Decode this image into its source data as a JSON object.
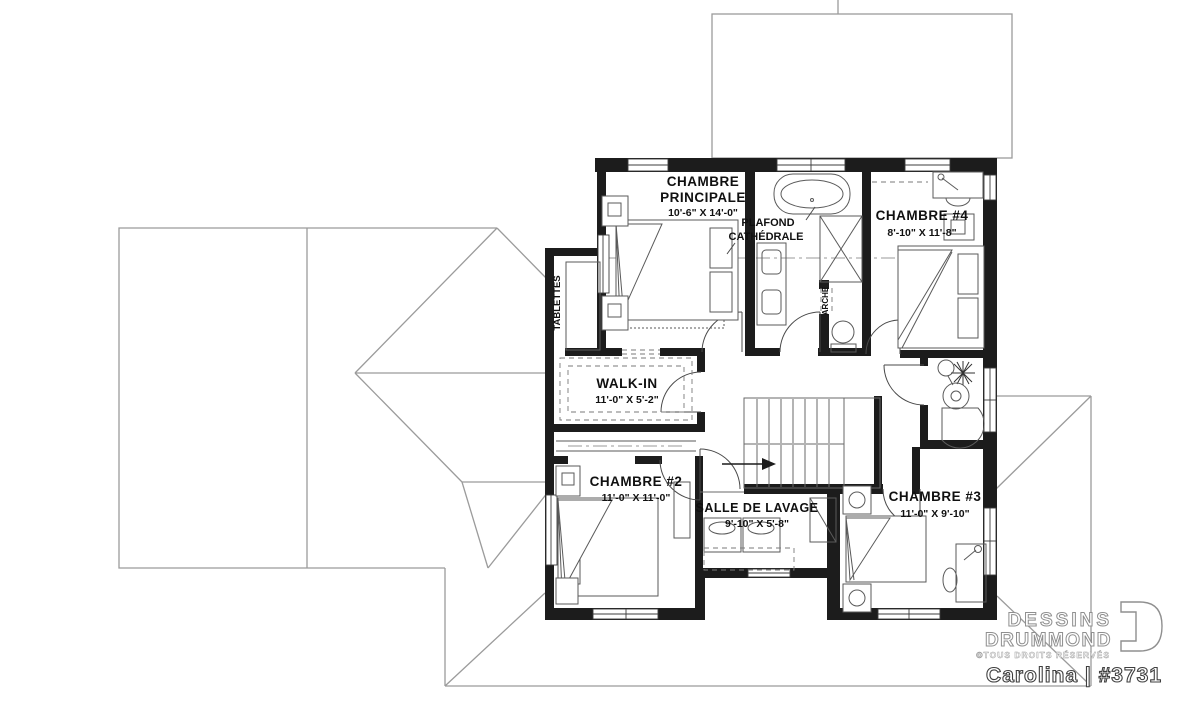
{
  "branding": {
    "brand_line1": "DESSINS",
    "brand_line2": "DRUMMOND",
    "copyright": "©TOUS DROITS RÉSERVÉS",
    "model_label": "Carolina | #3731"
  },
  "rooms": {
    "master": {
      "name_line1": "CHAMBRE",
      "name_line2": "PRINCIPALE",
      "dims": "10'-6\" X 14'-0\""
    },
    "bedroom4": {
      "name": "CHAMBRE #4",
      "dims": "8'-10\" X 11'-8\""
    },
    "walkin": {
      "name": "WALK-IN",
      "dims": "11'-0\" X 5'-2\""
    },
    "bedroom2": {
      "name": "CHAMBRE #2",
      "dims": "11'-0\" X 11'-0\""
    },
    "laundry": {
      "name": "SALLE DE LAVAGE",
      "dims": "9'-10\" X 5'-8\""
    },
    "bedroom3": {
      "name": "CHAMBRE #3",
      "dims": "11'-0\" X 9'-10\""
    }
  },
  "annotations": {
    "ceiling_line1": "PLAFOND",
    "ceiling_line2": "CATHÉDRALE",
    "shelves": "TABLETTES",
    "arch": "ARCHE"
  },
  "colors": {
    "wall": "#1c1c1c",
    "roof_line": "#9b9b9b",
    "furniture_line": "#5a5a5a",
    "text": "#101010",
    "background": "#ffffff"
  }
}
